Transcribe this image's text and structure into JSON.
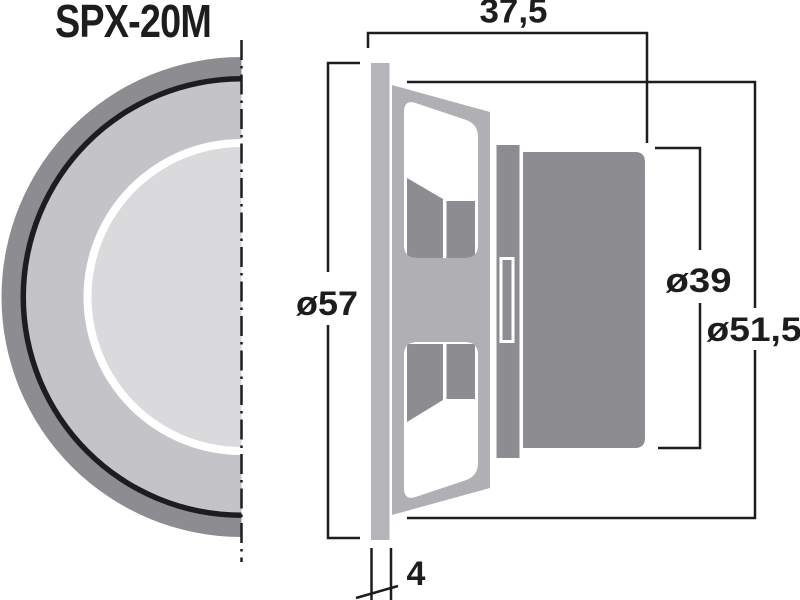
{
  "title": "SPX-20M",
  "drawing": {
    "type": "speaker-dimensional-drawing",
    "views": {
      "front": "half front view of round speaker with centerline",
      "side": "cross-section side view with flange, basket, front plate and magnet"
    }
  },
  "dimensions": {
    "depth_overall": "37,5",
    "outer_diameter": "ø57",
    "magnet_diameter": "ø39",
    "basket_diameter": "ø51,5",
    "flange_thickness": "4"
  },
  "colors": {
    "line": "#1d1d1f",
    "frame_gray": "#8d8d91",
    "flange_gray": "#b5b5b9",
    "basket_gray": "#b0b0b4",
    "surround_gray": "#c4c4c8",
    "cone_gray": "#dadadc",
    "white": "#ffffff",
    "background": "#ffffff"
  }
}
